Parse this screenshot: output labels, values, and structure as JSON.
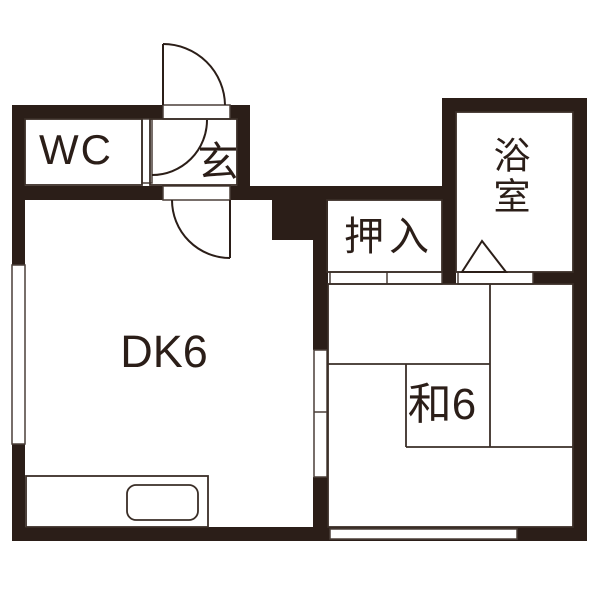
{
  "plan": {
    "type": "apartment-floor-plan",
    "colors": {
      "background": "#ffffff",
      "wall": "#2b1e18",
      "thin_line": "#3a2e27",
      "opening_outline": "#4a3f38",
      "label_text": "#2b1e18"
    },
    "rooms": {
      "wc": {
        "label": "WC"
      },
      "entrance": {
        "label": "玄"
      },
      "bathroom": {
        "label": "浴室"
      },
      "closet": {
        "label": "押入"
      },
      "dining_kitchen": {
        "label": "DK6"
      },
      "japanese_room": {
        "label": "和6"
      }
    }
  }
}
